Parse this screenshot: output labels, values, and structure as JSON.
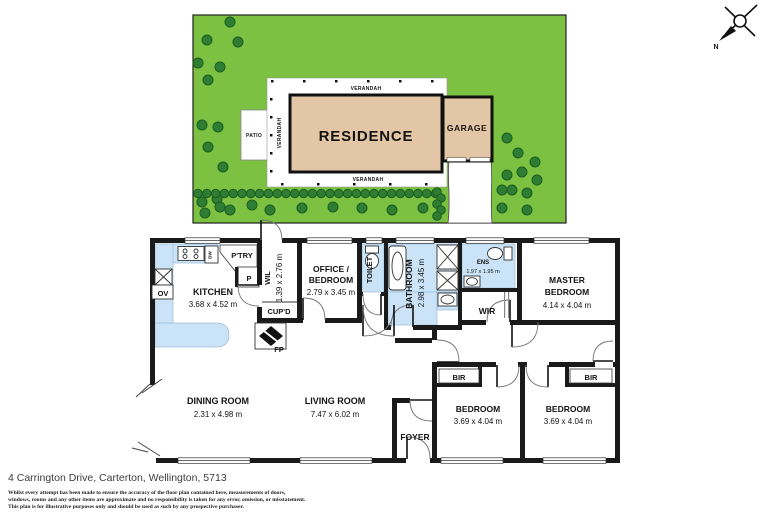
{
  "site_plan": {
    "labels": {
      "residence": "RESIDENCE",
      "garage": "GARAGE",
      "patio": "PATIO",
      "verandah_top": "VERANDAH",
      "verandah_left": "VERANDAH",
      "verandah_bottom": "VERANDAH"
    },
    "compass": {
      "north": "N"
    },
    "colors": {
      "grass": "#7cc142",
      "tree": "#2e7d32",
      "tree_edge": "#1c5e20",
      "building": "#e3c6a6",
      "wall": "#1a1a1a",
      "wet_area": "#cae3f6"
    },
    "vegetation": {
      "trees": [
        [
          230,
          22
        ],
        [
          207,
          40
        ],
        [
          238,
          42
        ],
        [
          198,
          63
        ],
        [
          220,
          67
        ],
        [
          208,
          80
        ],
        [
          202,
          125
        ],
        [
          218,
          127
        ],
        [
          208,
          147
        ],
        [
          223,
          167
        ],
        [
          202,
          202
        ],
        [
          217,
          199
        ],
        [
          230,
          210
        ],
        [
          205,
          213
        ],
        [
          220,
          207
        ],
        [
          252,
          205
        ],
        [
          270,
          210
        ],
        [
          302,
          208
        ],
        [
          333,
          207
        ],
        [
          362,
          208
        ],
        [
          392,
          210
        ],
        [
          423,
          208
        ],
        [
          507,
          138
        ],
        [
          518,
          153
        ],
        [
          535,
          162
        ],
        [
          507,
          175
        ],
        [
          522,
          172
        ],
        [
          537,
          180
        ],
        [
          502,
          190
        ],
        [
          512,
          190
        ],
        [
          527,
          193
        ],
        [
          502,
          208
        ],
        [
          527,
          210
        ]
      ],
      "bush_row": {
        "y": 193.5,
        "x_start": 198,
        "count": 28,
        "step": 8.8,
        "r": 4.3
      },
      "bush_cluster": [
        [
          437,
          192
        ],
        [
          441,
          198
        ],
        [
          437,
          204
        ],
        [
          441,
          210
        ],
        [
          437,
          216
        ]
      ]
    }
  },
  "floor_plan": {
    "rooms": {
      "kitchen": {
        "name": "KITCHEN",
        "dims": "3.68 x 4.52 m"
      },
      "office": {
        "name_line1": "OFFICE /",
        "name_line2": "BEDROOM",
        "dims": "2.79 x 3.45 m"
      },
      "wil": {
        "name": "WIL",
        "dims": "1.39 x 2.76 m"
      },
      "toilet": {
        "name": "TOILET"
      },
      "bathroom": {
        "name": "BATHROOM",
        "dims": "2.98 x 3.45 m"
      },
      "ens": {
        "name": "ENS",
        "dims": "1.97 x 1.95 m"
      },
      "wir": {
        "name": "WIR"
      },
      "master_bedroom": {
        "name_line1": "MASTER",
        "name_line2": "BEDROOM",
        "dims": "4.14 x 4.04 m"
      },
      "dining": {
        "name": "DINING ROOM",
        "dims": "2.31 x 4.98 m"
      },
      "living": {
        "name": "LIVING ROOM",
        "dims": "7.47 x 6.02 m"
      },
      "foyer": {
        "name": "FOYER"
      },
      "bedroom_left": {
        "name": "BEDROOM",
        "dims": "3.69 x 4.04 m"
      },
      "bedroom_right": {
        "name": "BEDROOM",
        "dims": "3.69 x 4.04 m"
      }
    },
    "features": {
      "pantry": "P'TRY",
      "p": "P",
      "cupboard": "CUP'D",
      "fireplace": "FP",
      "oven": "OV",
      "dishwasher": "DW",
      "bir_left": "BIR",
      "bir_right": "BIR"
    }
  },
  "footer": {
    "address": "4 Carrington Drive, Carterton, Wellington, 5713",
    "disclaimer_lines": [
      "Whilst every attempt has been made to ensure the accuracy of the floor plan contained here, measurements of doors,",
      "windows, rooms and any other items are approximate and no responsibility is taken for any error, omission, or misstatement.",
      "This plan is for illustrative purposes only and should be used as such by any prospective purchaser."
    ]
  }
}
